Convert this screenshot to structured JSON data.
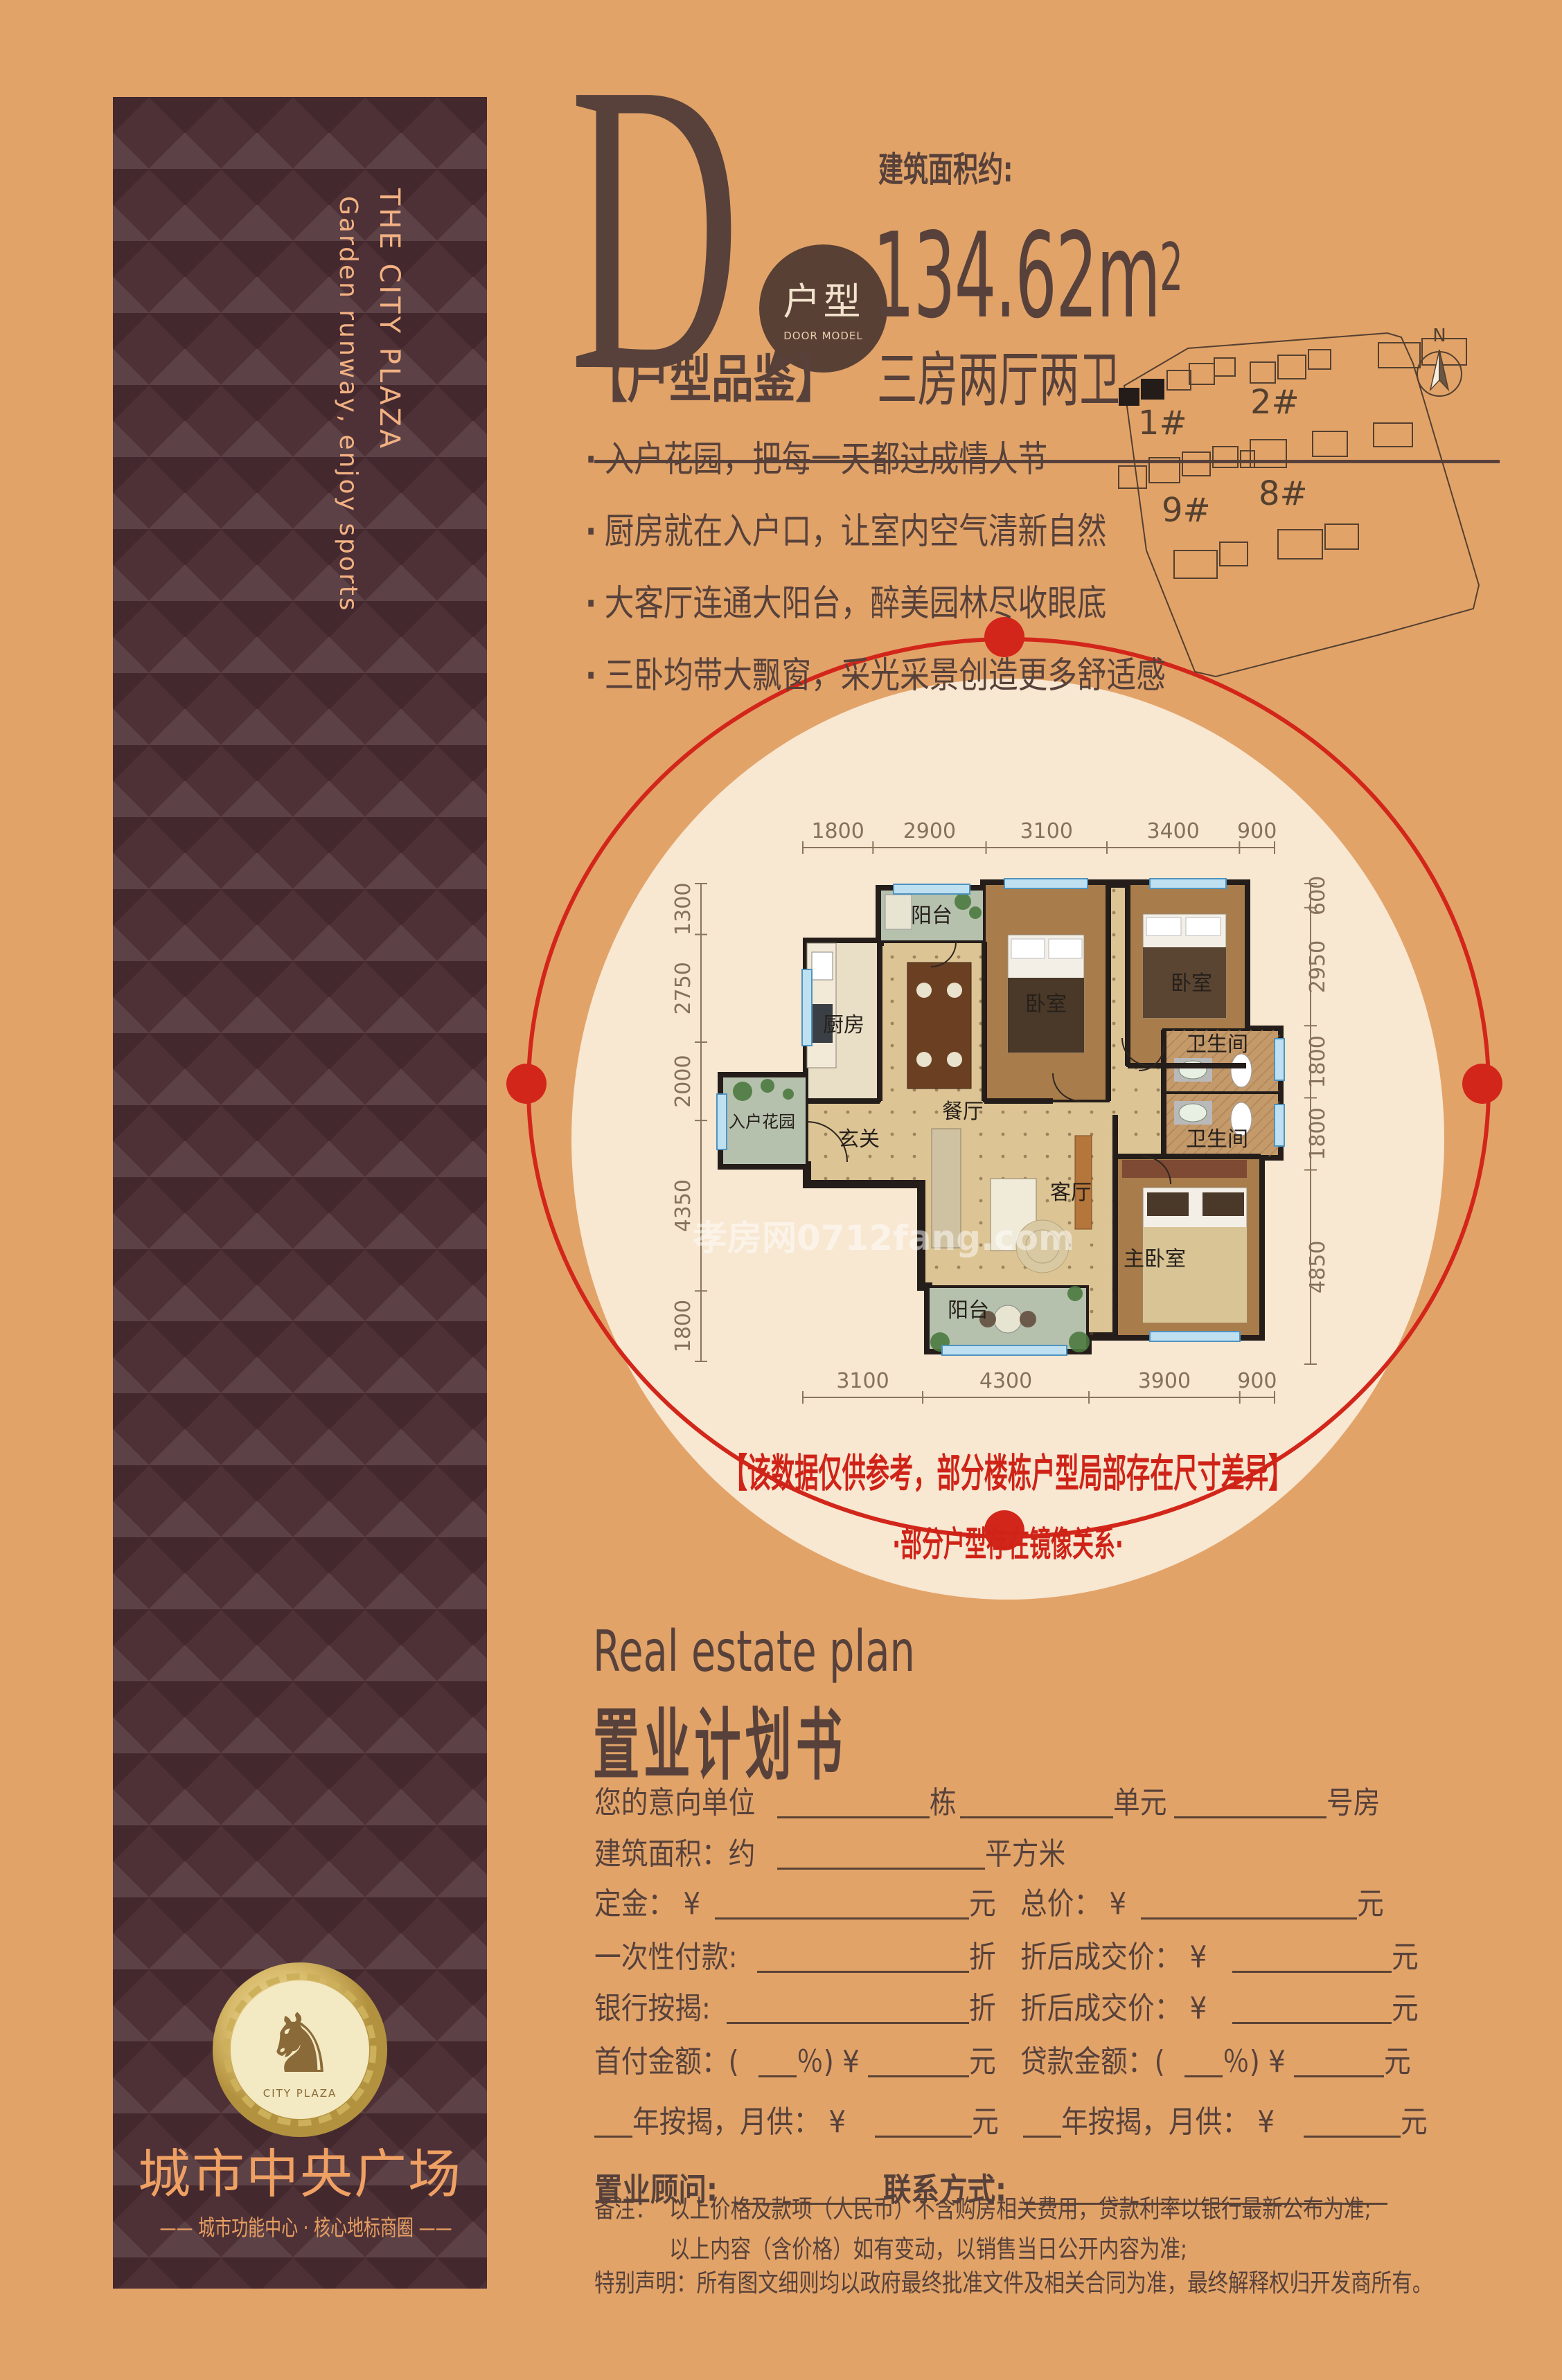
{
  "colors": {
    "background": "#e2a369",
    "banner": "#4e3136",
    "dark_text": "#57413a",
    "peach": "#f2b183",
    "gold": "#efa063",
    "accent_red": "#d3261a",
    "disc_cream": "#f8e7d1"
  },
  "banner": {
    "english_line1": "THE CITY PLAZA",
    "english_line2": "Garden runway, enjoy sports",
    "logo_glyph": "♞",
    "logo_text": "CITY PLAZA",
    "brand": "城市中央广场",
    "brand_sub": "—— 城市功能中心 · 核心地标商圈 ——"
  },
  "header": {
    "letter": "D",
    "bubble_label": "户型",
    "bubble_sub": "DOOR MODEL",
    "area_label": "建筑面积约:",
    "area_value": "134.62m",
    "area_value_sup": "2",
    "layout_desc": "三房两厅两卫"
  },
  "appraisal": {
    "title": "【户型品鉴】",
    "bullets": [
      "入户花园，把每一天都过成情人节",
      "厨房就在入户口，让室内空气清新自然",
      "大客厅连通大阳台，醉美园林尽收眼底",
      "三卧均带大飘窗，采光采景创造更多舒适感"
    ]
  },
  "site_map": {
    "compass": "N",
    "building_labels": [
      "1#",
      "2#",
      "9#",
      "8#"
    ]
  },
  "floor_plan": {
    "watermark": "孝房网0712fang.com",
    "rooms": {
      "balcony_top": "阳台",
      "kitchen": "厨房",
      "bedroom_a": "卧室",
      "bedroom_b": "卧室",
      "dining": "餐厅",
      "entry": "玄关",
      "entry_garden": "入户花园",
      "bath_a": "卫生间",
      "bath_b": "卫生间",
      "living": "客厅",
      "master": "主卧室",
      "balcony_bottom": "阳台"
    },
    "dims": {
      "top": [
        1800,
        2900,
        3100,
        3400,
        900
      ],
      "bottom": [
        3100,
        4300,
        3900,
        900
      ],
      "left": [
        1300,
        2750,
        2000,
        4350,
        1800
      ],
      "right": [
        600,
        2950,
        1800,
        1800,
        4850
      ]
    }
  },
  "disclaimer": {
    "line1": "【该数据仅供参考，部分楼栋户型局部存在尺寸差异】",
    "line2": "·部分户型存在镜像关系·"
  },
  "plan_doc": {
    "title_en": "Real estate plan",
    "title_cn": "置业计划书",
    "rows": [
      {
        "cols": [
          [
            {
              "t": "您的意向单位"
            },
            {
              "u": 185,
              "g": 1
            },
            {
              "t": "栋"
            },
            {
              "u": 175,
              "g": 1
            },
            {
              "t": "单元"
            },
            {
              "u": 180,
              "g": 1
            },
            {
              "t": "号房"
            }
          ]
        ]
      },
      {
        "cols": [
          [
            {
              "t": "建筑面积：约"
            },
            {
              "u": 300
            },
            {
              "t": "平方米"
            }
          ]
        ]
      },
      {
        "cols": [
          [
            {
              "t": "定金： ¥"
            },
            {
              "u": 300,
              "g": 1
            },
            {
              "t": "元"
            }
          ],
          [
            {
              "t": "总价： ¥"
            },
            {
              "u": 300,
              "g": 1
            },
            {
              "t": "元"
            }
          ]
        ]
      },
      {
        "cols": [
          [
            {
              "t": "一次性付款:"
            },
            {
              "u": 260,
              "g": 1
            },
            {
              "t": "折"
            }
          ],
          [
            {
              "t": "折后成交价： ¥"
            },
            {
              "u": 230,
              "g": 1
            },
            {
              "t": "元"
            }
          ]
        ]
      },
      {
        "cols": [
          [
            {
              "t": "银行按揭:"
            },
            {
              "u": 280,
              "g": 1
            },
            {
              "t": "折"
            }
          ],
          [
            {
              "t": "折后成交价： ¥"
            },
            {
              "u": 230,
              "g": 1
            },
            {
              "t": "元"
            }
          ]
        ]
      },
      {
        "cols": [
          [
            {
              "t": "首付金额：("
            },
            {
              "u": 55
            },
            {
              "t": "％) ¥"
            },
            {
              "u": 140,
              "g": 1
            },
            {
              "t": "元"
            }
          ],
          [
            {
              "t": "贷款金额：("
            },
            {
              "u": 55
            },
            {
              "t": "％) ¥"
            },
            {
              "u": 130,
              "g": 1
            },
            {
              "t": "元"
            }
          ]
        ]
      },
      {
        "cols": [
          [
            {
              "u": 55
            },
            {
              "t": "年按揭，月供： ¥"
            },
            {
              "u": 140,
              "g": 1
            },
            {
              "t": "元"
            }
          ],
          [
            {
              "u": 55
            },
            {
              "t": "年按揭，月供： ¥"
            },
            {
              "u": 140,
              "g": 1
            },
            {
              "t": "元"
            }
          ]
        ]
      },
      {
        "cols": [
          [
            {
              "b": "置业顾问:"
            },
            {
              "u": 215
            },
            {
              "b": "联系方式:"
            },
            {
              "u": 430,
              "g": 1
            }
          ]
        ]
      }
    ],
    "notes_label": "备注：",
    "notes": [
      "以上价格及款项（人民币）不含购房相关费用，贷款利率以银行最新公布为准;",
      "以上内容（含价格）如有变动，以销售当日公开内容为准;"
    ],
    "statement": "特别声明：所有图文细则均以政府最终批准文件及相关合同为准，最终解释权归开发商所有。"
  }
}
